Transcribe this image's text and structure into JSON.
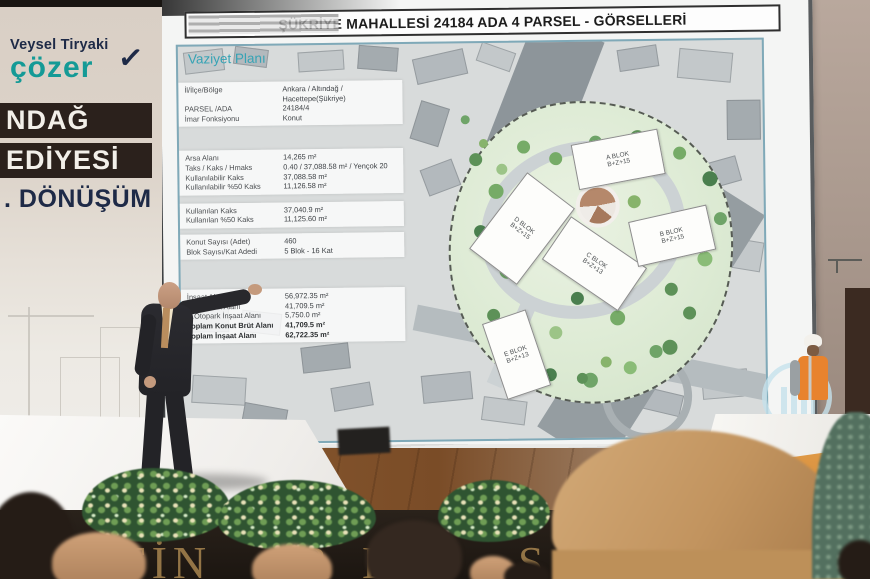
{
  "event": {
    "rollup": {
      "brand_top": "Veysel Tiryaki",
      "brand_name": "çözer",
      "check_icon": "✓",
      "title_lines": [
        "NDAĞ",
        "EDİYESİ",
        ". DÖNÜŞÜM"
      ]
    },
    "stage_front_fragments": [
      "FİN",
      "R",
      "ER",
      "Ş"
    ]
  },
  "slide": {
    "title": "ŞÜKRİYE MAHALLESİ  24184 ADA 4 PARSEL - GÖRSELLERİ",
    "section_label": "Vaziyet Planı",
    "info": {
      "sections": [
        {
          "rows": [
            {
              "label": "İl/İlçe/Bölge",
              "value": "Ankara / Altındağ / Hacettepe(Şükriye)"
            },
            {
              "label": "PARSEL /ADA",
              "value": "24184/4"
            },
            {
              "label": "İmar Fonksiyonu",
              "value": "Konut"
            }
          ]
        },
        {
          "rows": [
            {
              "label": "Arsa Alanı",
              "value": "14,265 m²"
            },
            {
              "label": "Taks / Kaks / Hmaks",
              "value": "0.40 / 37,088.58 m² / Yençok 20"
            },
            {
              "label": "Kullanılabilir Kaks",
              "value": "37,088.58 m²"
            },
            {
              "label": "Kullanılabilir %50 Kaks",
              "value": "11,126.58 m²"
            }
          ]
        },
        {
          "rows": [
            {
              "label": "Kullanılan Kaks",
              "value": "37,040.9 m²"
            },
            {
              "label": "Kullanılan %50 Kaks",
              "value": "11,125.60 m²"
            }
          ]
        },
        {
          "rows": [
            {
              "label": "Konut Sayısı (Adet)",
              "value": "460"
            },
            {
              "label": "Blok Sayısı/Kat Adedi",
              "value": "5 Blok - 16 Kat"
            }
          ]
        },
        {
          "rows": [
            {
              "label": "İnşaat Alanı",
              "value": "56,972.35 m²"
            },
            {
              "label": "Konut Brüt Alanı",
              "value": "41,709.5 m²"
            },
            {
              "label": "K.Otopark İnşaat Alanı",
              "value": "5,750.0 m²"
            },
            {
              "label": "Toplam Konut Brüt Alanı",
              "value": "41,709.5 m²"
            },
            {
              "label": "Toplam İnşaat Alanı",
              "value": "62,722.35 m²"
            }
          ]
        }
      ]
    },
    "blocks": [
      {
        "name": "A BLOK",
        "floors": "B+Z+15"
      },
      {
        "name": "D BLOK",
        "floors": "B+Z+15"
      },
      {
        "name": "C BLOK",
        "floors": "B+Z+13"
      },
      {
        "name": "B BLOK",
        "floors": "B+Z+15"
      },
      {
        "name": "E BLOK",
        "floors": "B+Z+13"
      }
    ]
  },
  "colors": {
    "accent_teal": "#35a3b5",
    "brand_teal": "#149a96",
    "banner_dark": "#2b211c",
    "navy": "#1e2a47",
    "stage_gold": "#a8854f",
    "vest_orange": "#e8832e"
  }
}
